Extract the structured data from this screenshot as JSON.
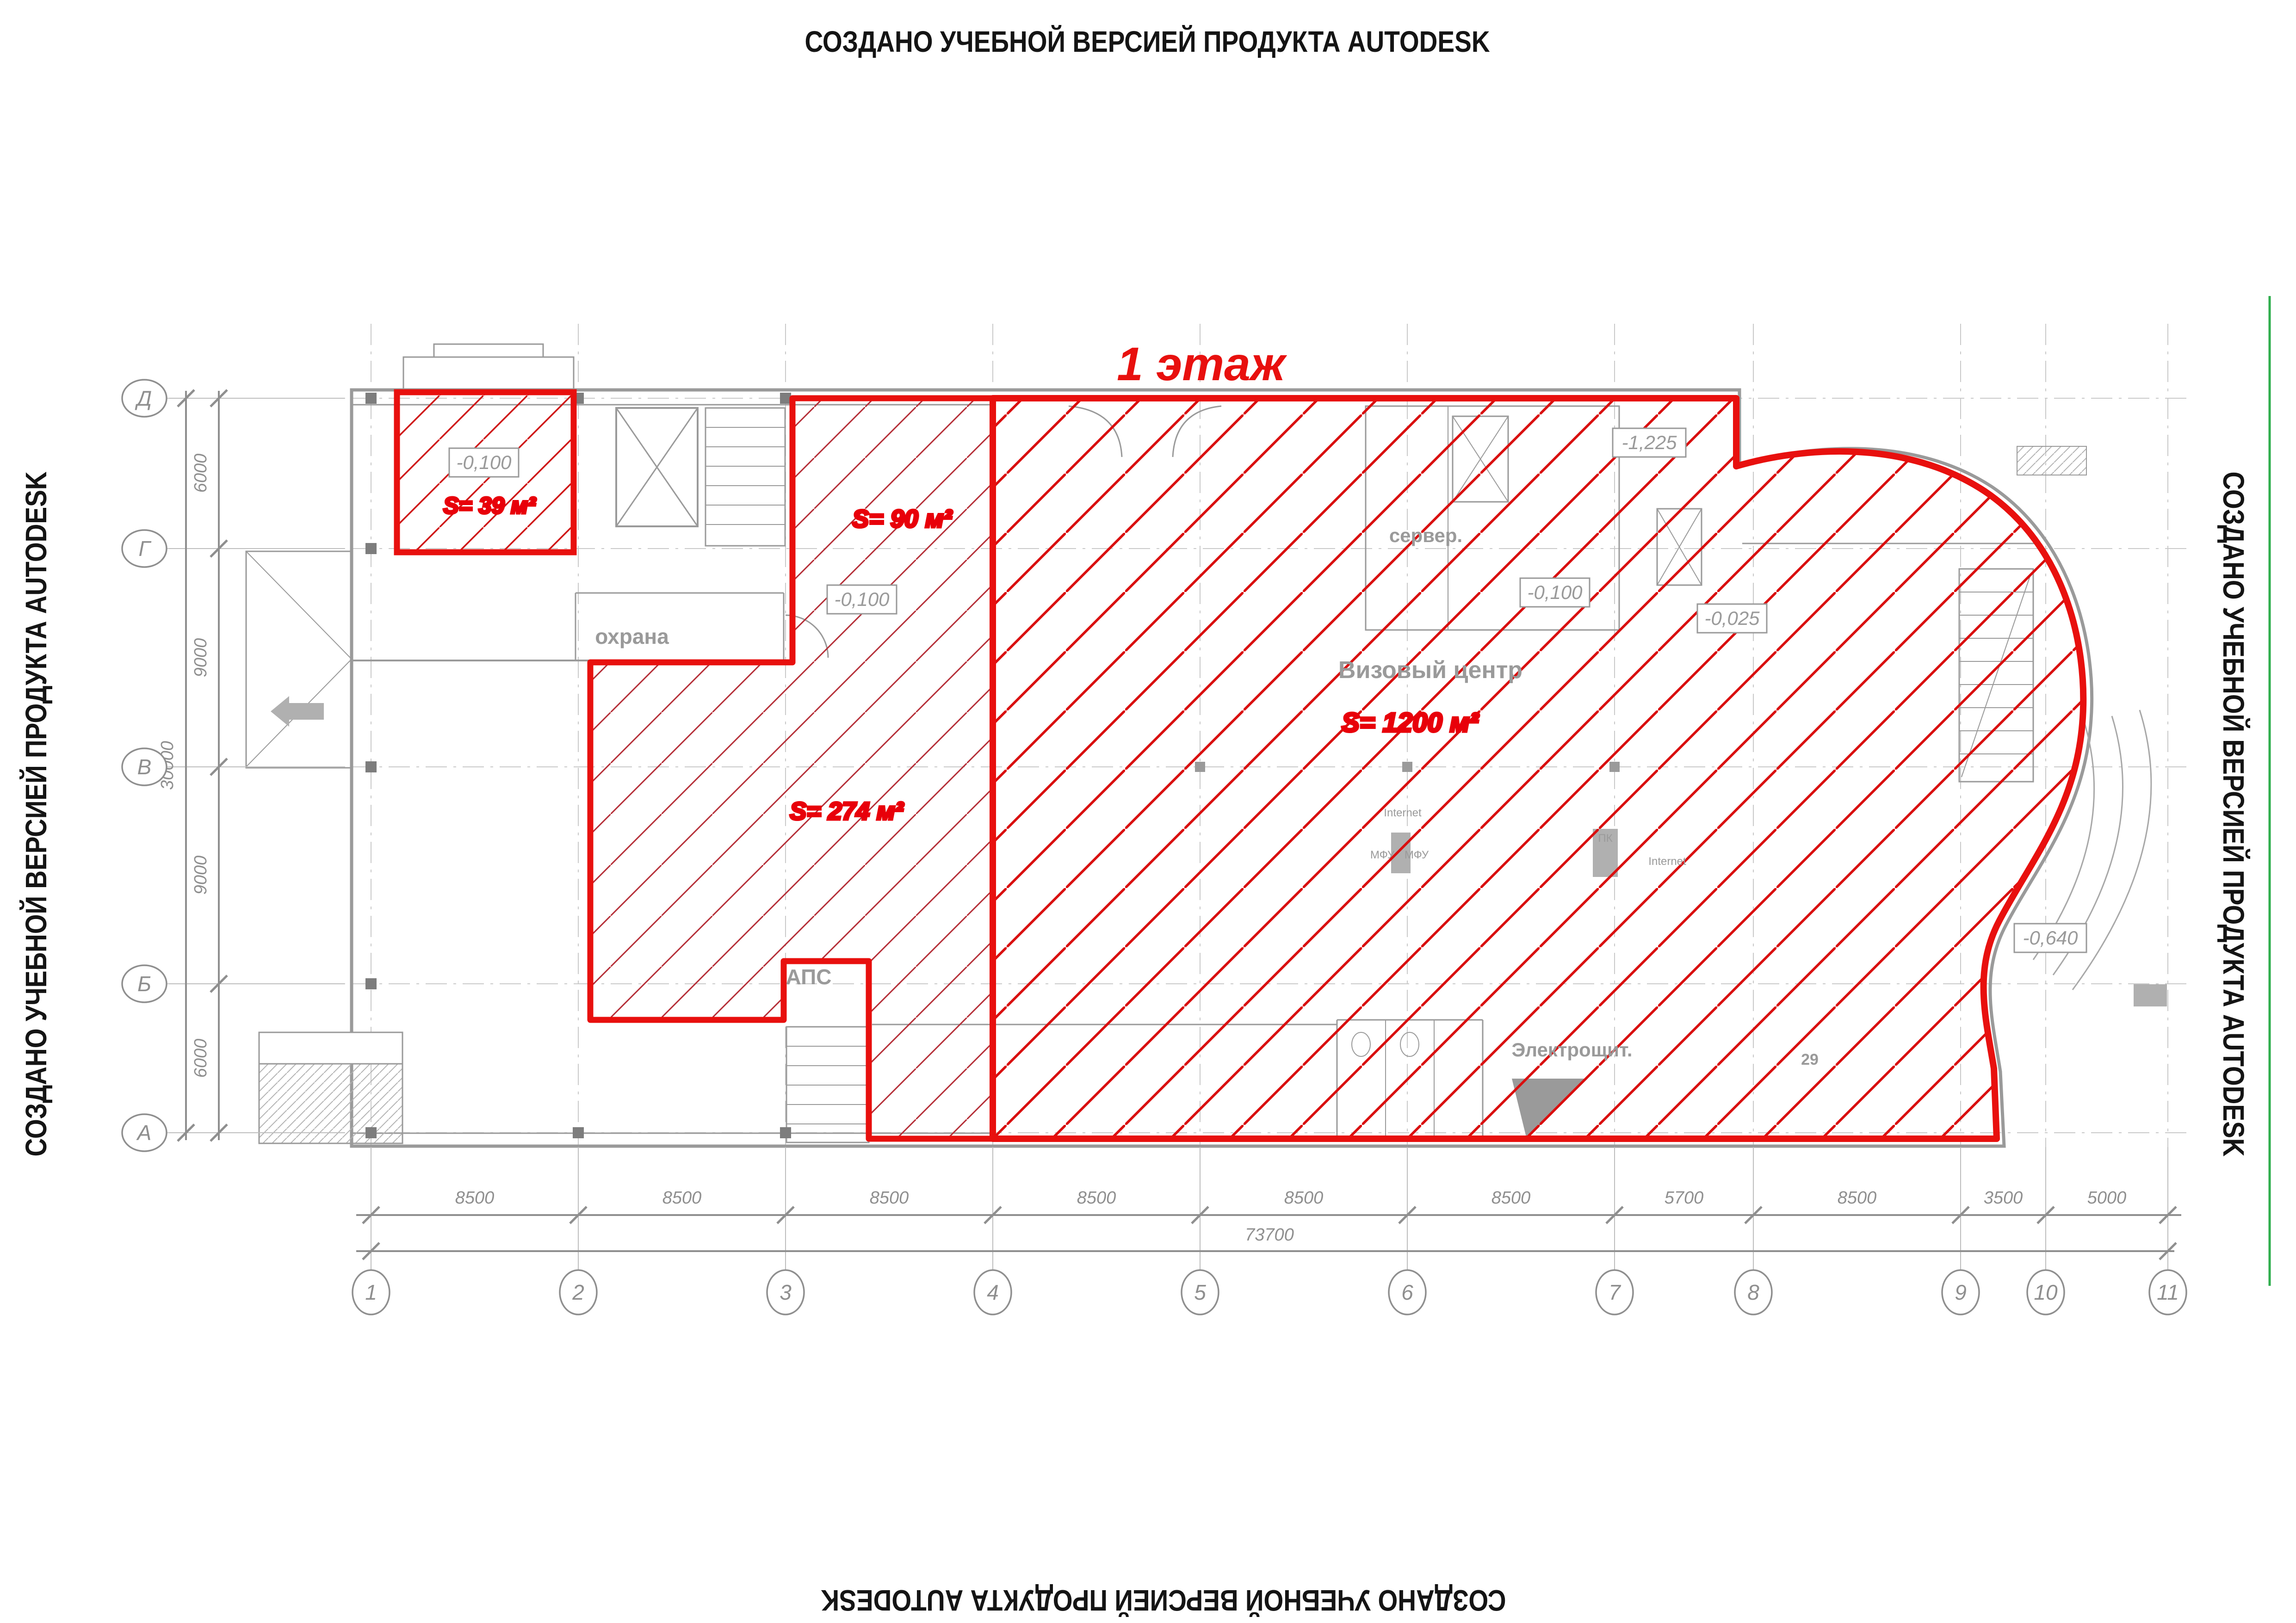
{
  "watermark": {
    "text": "СОЗДАНО УЧЕБНОЙ ВЕРСИЕЙ ПРОДУКТА AUTODESK"
  },
  "title": {
    "text": "1 этаж"
  },
  "zones": {
    "zone_a": {
      "area": "S= 39 м²",
      "elevation": "-0,100"
    },
    "zone_b": {
      "area": "S= 90 м²",
      "elevation": "-0,100"
    },
    "zone_c": {
      "area": "S= 274 м²"
    },
    "zone_d": {
      "area": "S= 1200 м²",
      "name": "Визовый центр",
      "elevation_a": "-0,100",
      "elevation_b": "-0,025"
    }
  },
  "rooms": {
    "security": "охрана",
    "server": "сервер.",
    "fire_alarm": "АПС",
    "electrical": "Электрощит.",
    "room_29": "29"
  },
  "devices": {
    "internet": "Internet",
    "mfu": "МФУ",
    "pc": "ПК"
  },
  "site": {
    "entrance_elevation": "-1,225",
    "terrace_elevation": "-0,640"
  },
  "dims": {
    "bottom": [
      "8500",
      "8500",
      "8500",
      "8500",
      "8500",
      "8500",
      "5700",
      "8500",
      "3500",
      "5000"
    ],
    "bottom_total": "73700",
    "left": [
      "6000",
      "9000",
      "9000",
      "6000"
    ],
    "left_total": "30000"
  },
  "grid": {
    "cols": [
      "1",
      "2",
      "3",
      "4",
      "5",
      "6",
      "7",
      "8",
      "9",
      "10",
      "11"
    ],
    "rows": [
      "Д",
      "Г",
      "В",
      "Б",
      "А"
    ]
  },
  "colors": {
    "boundary_red": "#e8100e",
    "hatch_red": "#d90f0f",
    "hatch_dark_red": "#b52f38",
    "cad_gray": "#8f8f8f",
    "green_line": "#2fae4d",
    "label_red": "#e8000a"
  }
}
